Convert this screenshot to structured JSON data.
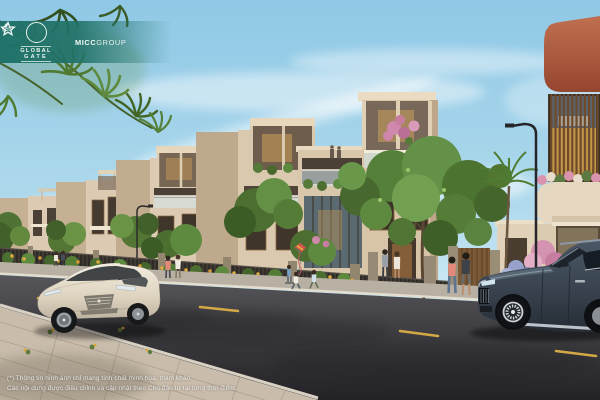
{
  "branding": {
    "global_gate": {
      "line1": "GLOBAL",
      "line2": "GATE",
      "emblem_icon": "sailboat-over-waves-circle-icon",
      "banner_color": "#1e7067"
    },
    "micc_group": {
      "bold": "MICC",
      "light": "GROUP",
      "icon": "star-outline-icon"
    }
  },
  "disclaimer": {
    "line1": "(*) Thông tin hình ảnh chỉ mang tính chất minh họa, tham khảo.",
    "line2": "Các nội dung được điều chỉnh và cập nhật theo Chủ đầu tư tại từng thời điểm."
  },
  "scene_colors": {
    "sky": "#a9d6ec",
    "facade_cream": "#dbc9af",
    "terracotta": "#b06047",
    "road": "#3c3b3f",
    "lane_marking_yellow": "#d2a944",
    "foliage_green": "#5d8a3c",
    "flower_pink": "#d493b0",
    "flower_yellow": "#e2ae3e",
    "sedan_white": "#e9e2d3",
    "suv_navy": "#3e4a58"
  },
  "scene_objects": [
    "townhouse-row",
    "terracotta-louver-building",
    "white-sedan",
    "navy-suv",
    "street-with-lane-markings",
    "paver-plaza",
    "palm-fronds",
    "pedestrians",
    "street-lamps"
  ]
}
